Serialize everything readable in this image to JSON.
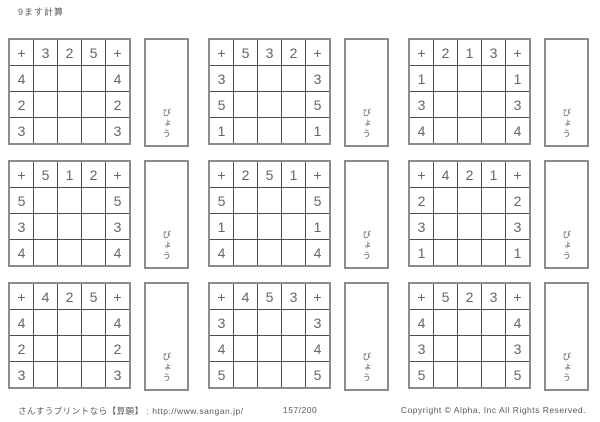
{
  "title": "9ます計算",
  "timer_label": "びょう",
  "grids": [
    {
      "operator": "+",
      "cols": [
        "3",
        "2",
        "5"
      ],
      "rows": [
        "4",
        "2",
        "3"
      ]
    },
    {
      "operator": "+",
      "cols": [
        "5",
        "3",
        "2"
      ],
      "rows": [
        "3",
        "5",
        "1"
      ]
    },
    {
      "operator": "+",
      "cols": [
        "2",
        "1",
        "3"
      ],
      "rows": [
        "1",
        "3",
        "4"
      ]
    },
    {
      "operator": "+",
      "cols": [
        "5",
        "1",
        "2"
      ],
      "rows": [
        "5",
        "3",
        "4"
      ]
    },
    {
      "operator": "+",
      "cols": [
        "2",
        "5",
        "1"
      ],
      "rows": [
        "5",
        "1",
        "4"
      ]
    },
    {
      "operator": "+",
      "cols": [
        "4",
        "2",
        "1"
      ],
      "rows": [
        "2",
        "3",
        "1"
      ]
    },
    {
      "operator": "+",
      "cols": [
        "4",
        "2",
        "5"
      ],
      "rows": [
        "4",
        "2",
        "3"
      ]
    },
    {
      "operator": "+",
      "cols": [
        "4",
        "5",
        "3"
      ],
      "rows": [
        "3",
        "4",
        "5"
      ]
    },
    {
      "operator": "+",
      "cols": [
        "5",
        "2",
        "3"
      ],
      "rows": [
        "4",
        "3",
        "5"
      ]
    }
  ],
  "footer": {
    "site": "さんすうプリントなら【算願】 : http://www.sangan.jp/",
    "page": "157/200",
    "copyright": "Copyright © Alpha, Inc All Rights Reserved."
  }
}
